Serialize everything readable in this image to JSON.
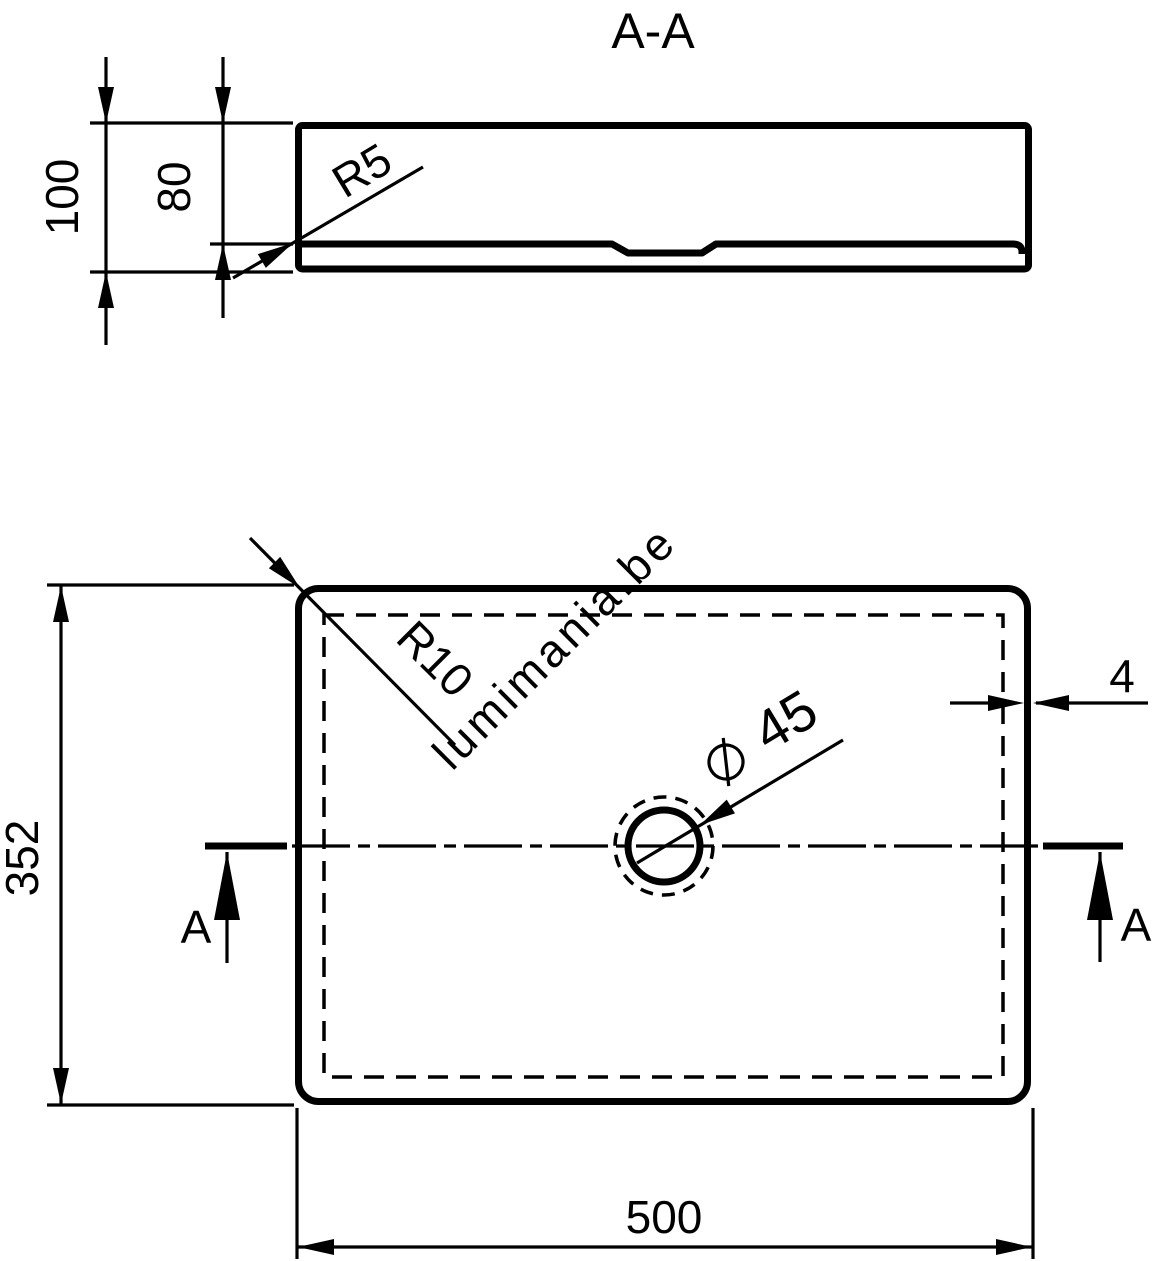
{
  "title": "A-A",
  "watermark": "lumimania.be",
  "colors": {
    "line": "#000000",
    "watermark": "#c9c9c9",
    "background": "#ffffff"
  },
  "section_view": {
    "dimensions": {
      "overall_height": "100",
      "basin_depth": "80",
      "bottom_radius": "R5"
    }
  },
  "plan_view": {
    "dimensions": {
      "width": "500",
      "depth": "352",
      "corner_radius": "R10",
      "drain_diameter_value": "45",
      "rim_thickness": "4"
    },
    "section_marker_left": "A",
    "section_marker_right": "A"
  }
}
